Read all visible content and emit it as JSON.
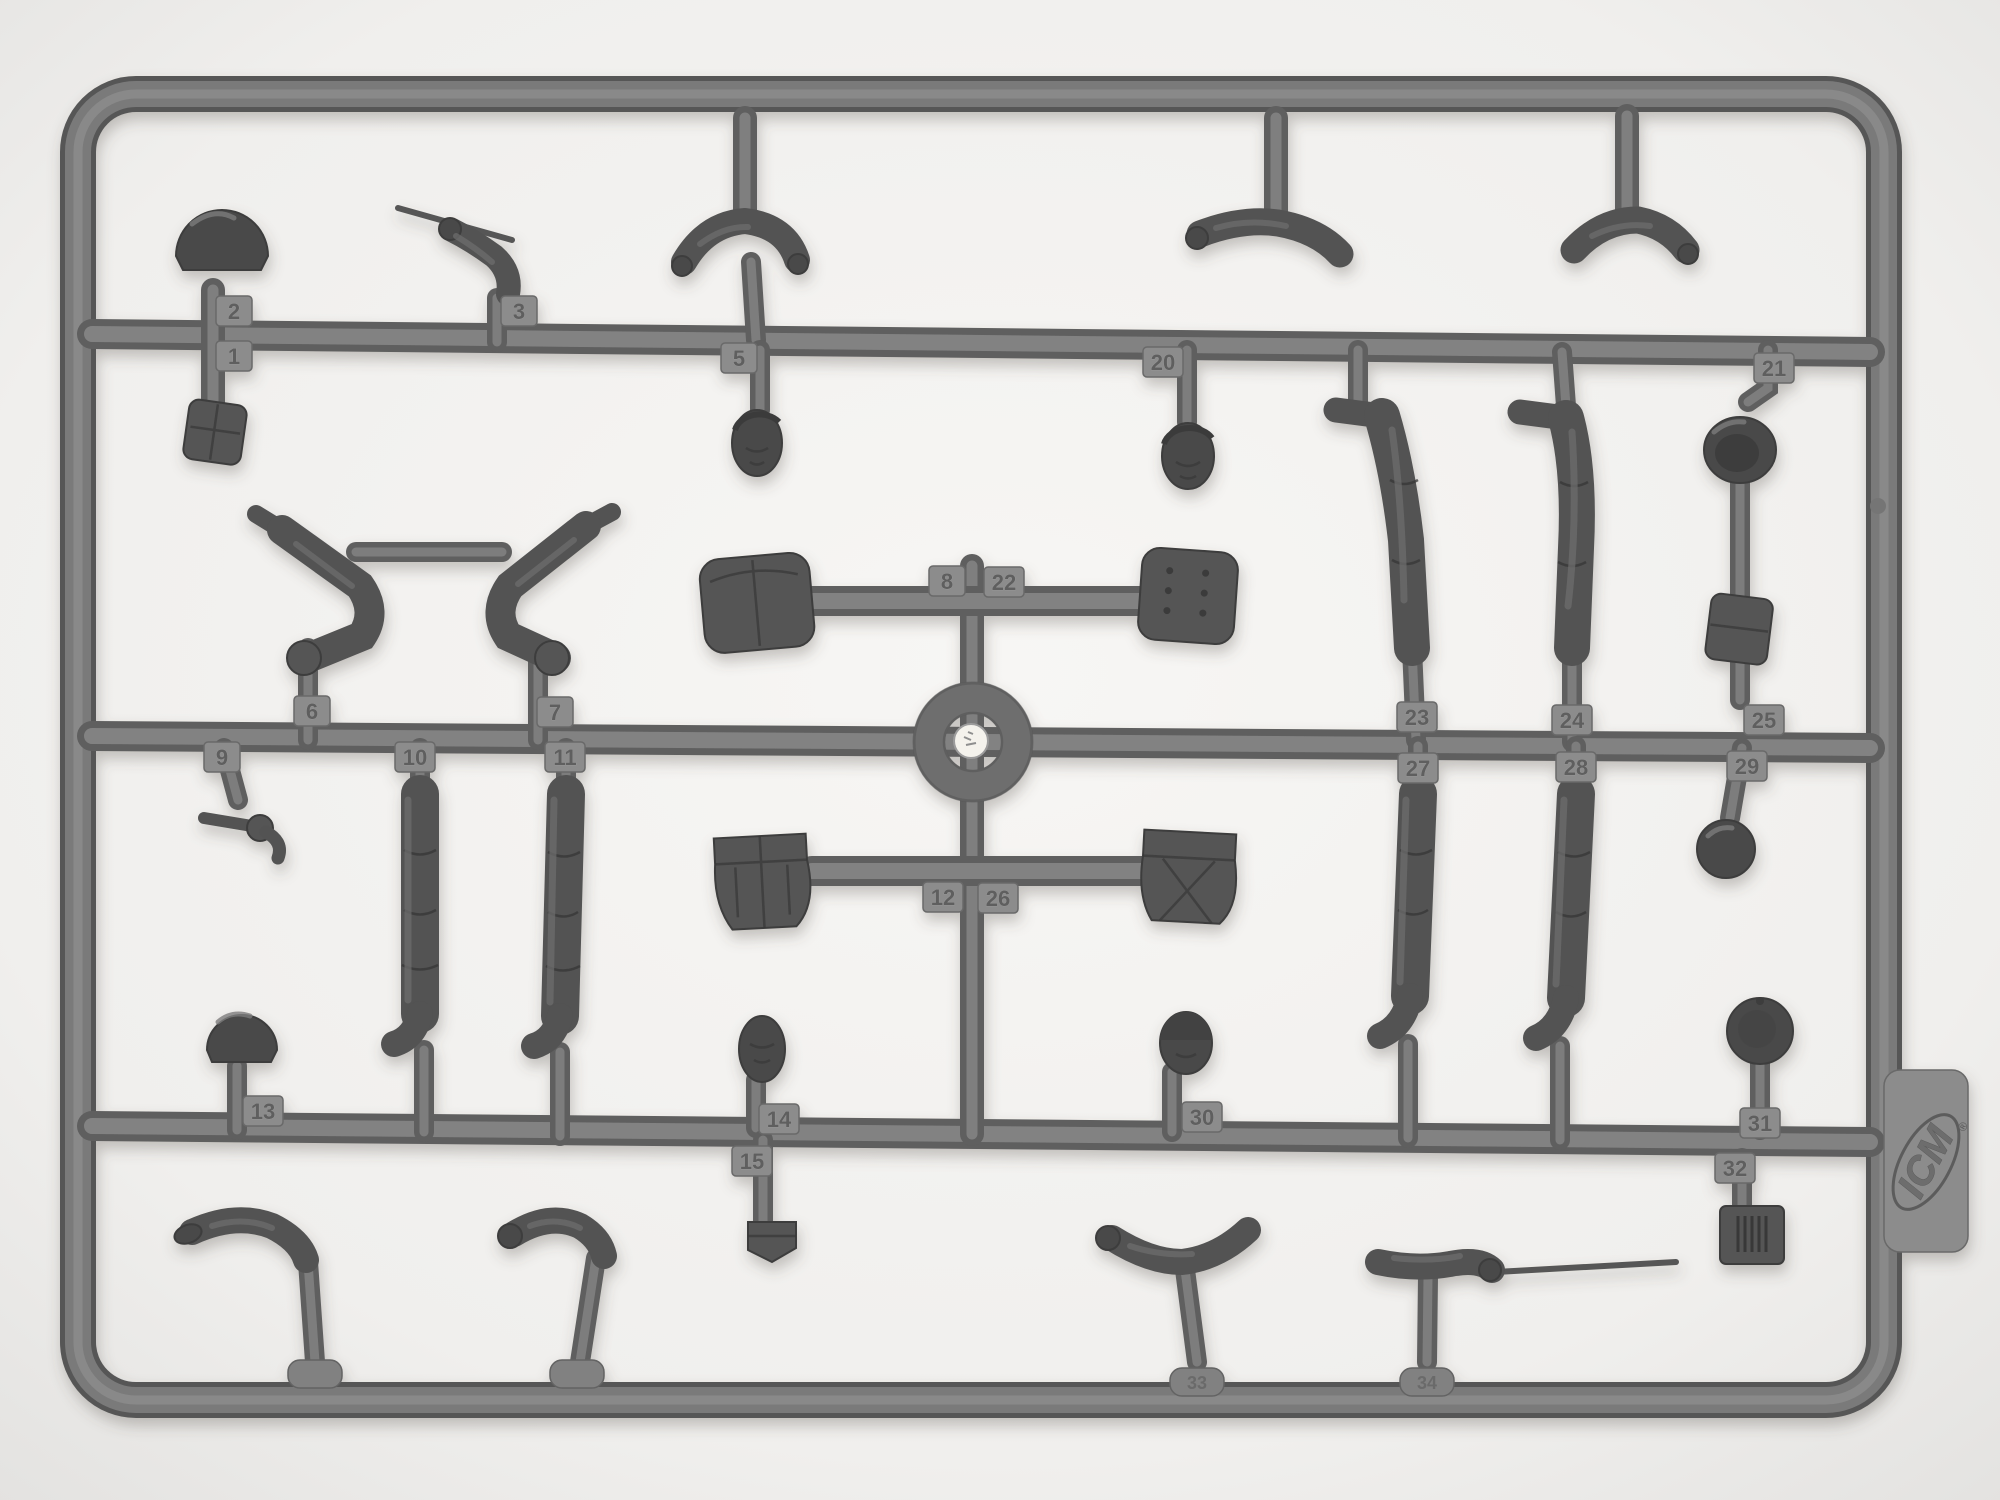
{
  "brand": {
    "logo_text": "ICM",
    "registered_mark": "®"
  },
  "part_labels": {
    "p1": "1",
    "p2": "2",
    "p3": "3",
    "p5": "5",
    "p6": "6",
    "p7": "7",
    "p8": "8",
    "p9": "9",
    "p10": "10",
    "p11": "11",
    "p12": "12",
    "p13": "13",
    "p14": "14",
    "p15": "15",
    "p20": "20",
    "p21": "21",
    "p22": "22",
    "p23": "23",
    "p24": "24",
    "p25": "25",
    "p26": "26",
    "p27": "27",
    "p28": "28",
    "p29": "29",
    "p30": "30",
    "p31": "31",
    "p32": "32",
    "p33": "33",
    "p34": "34"
  },
  "colors": {
    "background": "#f4f3f1",
    "plastic_mid": "#7a7a7a",
    "plastic_dark": "#545454",
    "plastic_light": "#8f8f8f",
    "tag_face": "#8c8c8c",
    "hub_center": "#f4f2ec"
  }
}
